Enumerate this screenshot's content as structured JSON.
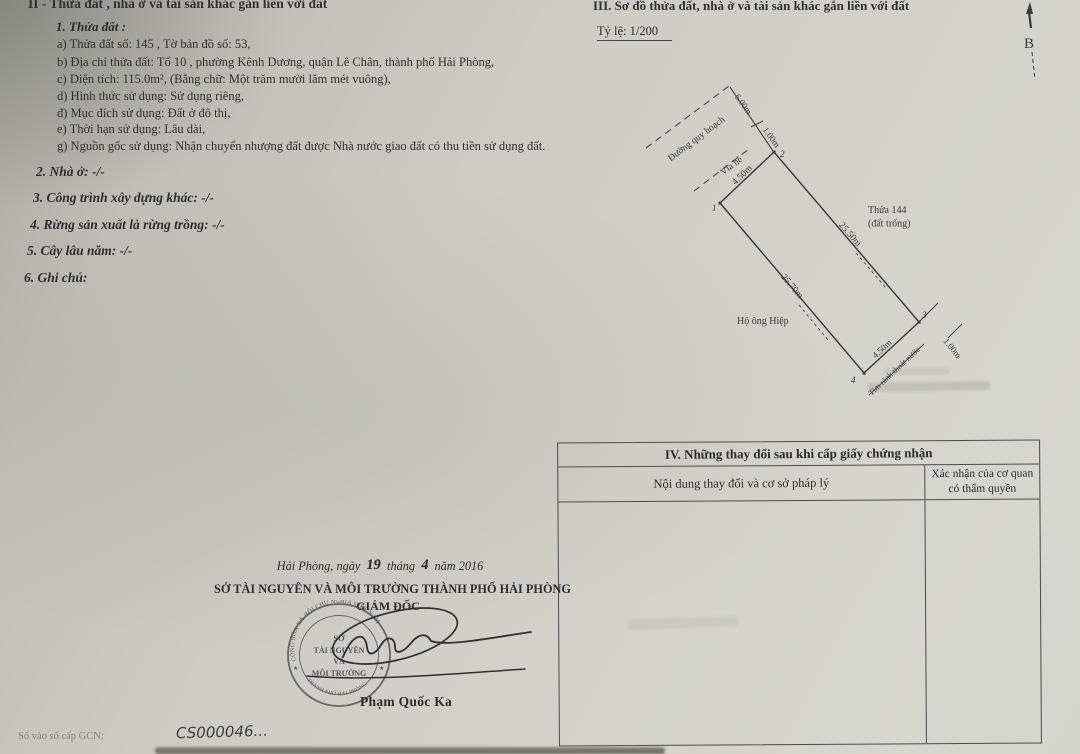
{
  "section2": {
    "title": "II - Thửa đất , nhà ở và tài sản khác gắn liền với đất",
    "plot": {
      "heading": "1. Thửa đất :",
      "items": [
        "a) Thửa đất số:  145 ,  Tờ bản đồ số:  53,",
        "b) Địa chỉ thửa đất:  Tổ 10 , phường Kênh Dương, quận Lê Chân, thành phố Hải Phòng,",
        "c) Diện tích: 115.0m²,   (Bằng chữ: Một trăm mười lăm mét vuông),",
        "d) Hình thức sử dụng: Sử dụng riêng,",
        "đ) Mục đích sử dụng: Đất ở đô thị,",
        "e) Thời hạn sử dụng: Lâu dài,",
        "g) Nguồn gốc sử dụng: Nhận chuyển nhượng đất được Nhà nước giao đất có thu tiền sử dụng đất."
      ]
    },
    "other_items": [
      "2. Nhà ở: -/-",
      "3. Công trình xây dựng khác: -/-",
      "4. Rừng sản xuất là rừng trồng: -/-",
      "5. Cây lâu năm: -/-",
      "6. Ghi chú:"
    ]
  },
  "section3": {
    "title": "III. Sơ đồ thửa đất, nhà ở và tài sản khác gắn liền với đất",
    "scale": "Tỷ lệ: 1/200",
    "north_label": "B",
    "diagram": {
      "road_label": "Đường quy hoạch",
      "sidewalk_label": "Vỉa hè",
      "neighbor_plot": "Thửa 144",
      "neighbor_plot_note": "(đất trống)",
      "neighbor_household": "Hộ ông Hiệp",
      "drain_label": "Tim rãnh thoát nước",
      "corners": [
        "1",
        "2",
        "3",
        "4"
      ],
      "dims": {
        "road_width": "6.00m",
        "sidewalk": "1.00m",
        "front": "4.50m",
        "right": "25.50m",
        "left": "25.70m",
        "back": "4.50m",
        "drain_width": "1.00m"
      }
    }
  },
  "section4": {
    "title": "IV. Những thay đổi sau khi cấp giấy chứng nhận",
    "col1": "Nội dung thay đổi và cơ sở pháp lý",
    "col2": "Xác nhận của cơ quan có thẩm quyền"
  },
  "signature": {
    "date_line": {
      "prefix": "Hải Phòng, ngày",
      "day": "19",
      "middle": "tháng",
      "month": "4",
      "suffix": "năm 2016"
    },
    "agency": "SỞ TÀI NGUYÊN VÀ MÔI TRƯỜNG THÀNH PHỐ HẢI PHÒNG",
    "role": "GIÁM ĐỐC",
    "signer": "Phạm Quốc Ka",
    "stamp": {
      "ring_top": "CỘNG HÒA XÃ HỘI CHỦ NGHĨA VIỆT NAM",
      "ring_bottom": "THÀNH PHỐ HẢI PHÒNG",
      "lines": [
        "SỞ",
        "TÀI NGUYÊN",
        "VÀ",
        "MÔI TRƯỜNG"
      ]
    }
  },
  "footer": {
    "label": "Số vào sổ cấp GCN:",
    "value": "CS000046..."
  }
}
